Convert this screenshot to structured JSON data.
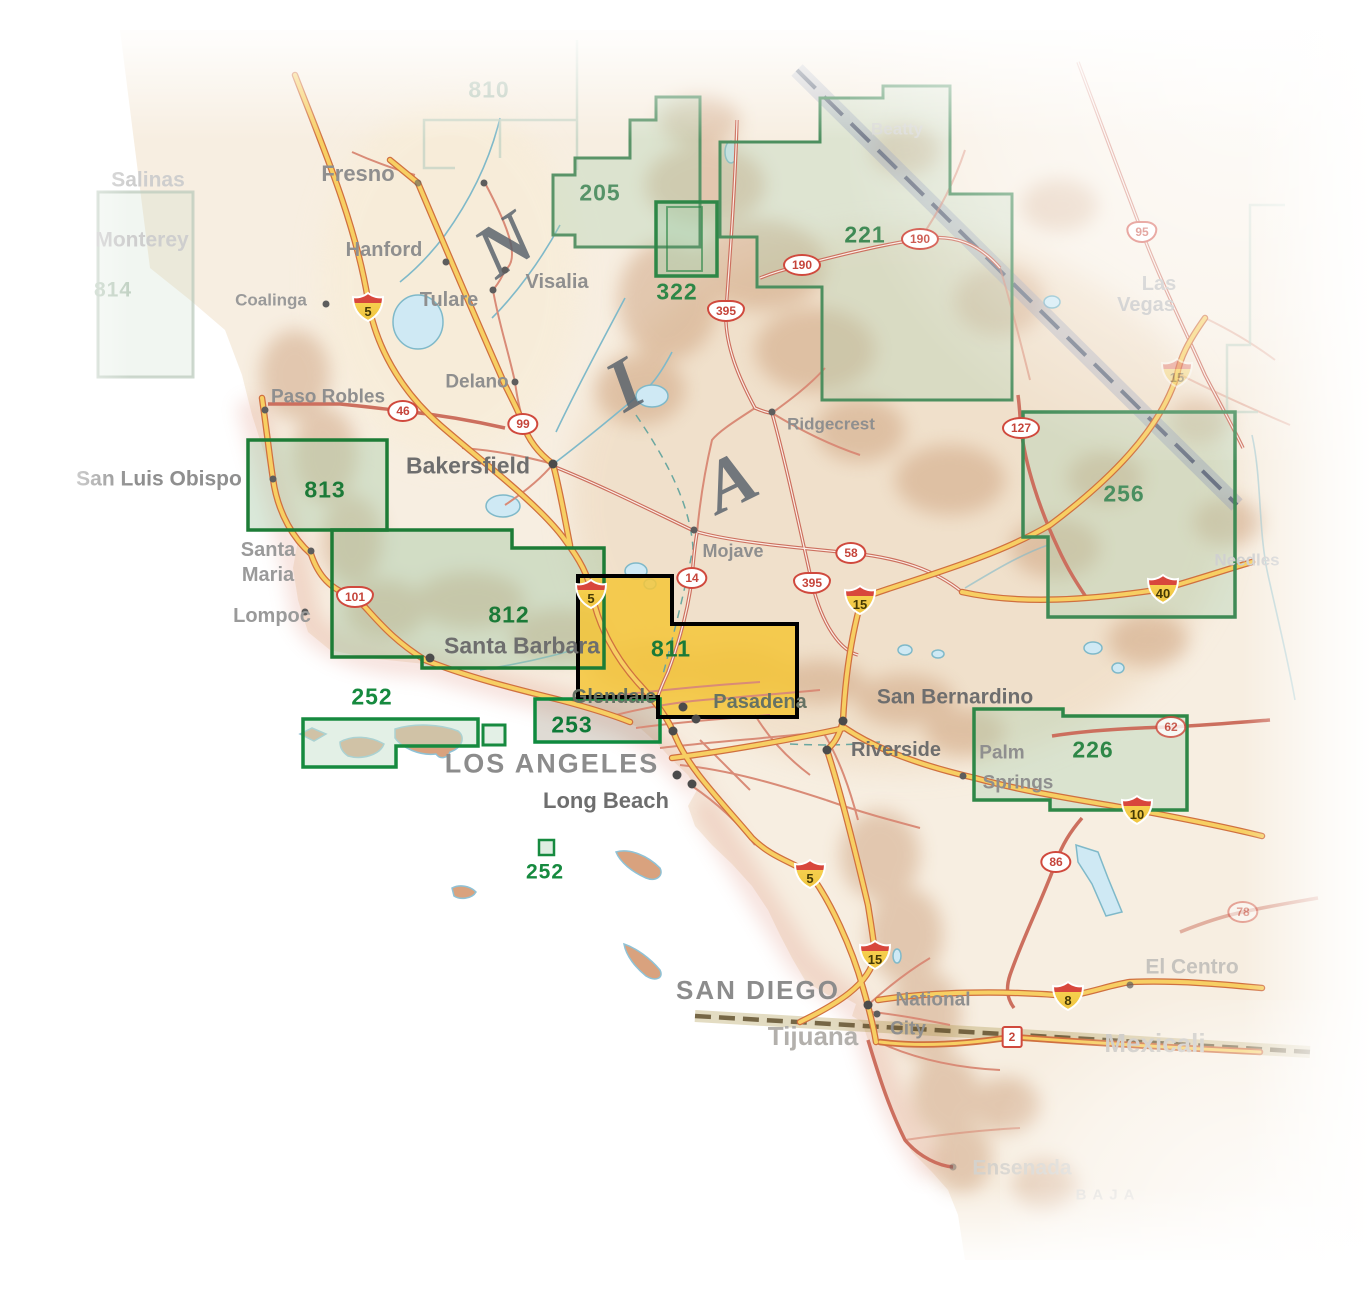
{
  "map_areas": {
    "a810": "810",
    "a814": "814",
    "a205": "205",
    "a322": "322",
    "a221": "221",
    "a813": "813",
    "a812": "812",
    "a811": "811",
    "a253": "253",
    "a252": "252",
    "a252b": "252",
    "a256": "256",
    "a226": "226"
  },
  "highlight": {
    "number": "811",
    "fill": "#F2C33C",
    "border": "#000000"
  },
  "colors": {
    "area_border": "#1E8040",
    "area_fill": "#BFD8C2",
    "number_green": "#1C7A38"
  },
  "letters": {
    "n": "N",
    "i": "I",
    "a": "A"
  },
  "cities": {
    "fresno": "Fresno",
    "hanford": "Hanford",
    "visalia": "Visalia",
    "tulare": "Tulare",
    "delano": "Delano",
    "coalinga": "Coalinga",
    "paso_robles": "Paso Robles",
    "san_luis_obispo": "San Luis Obispo",
    "santa_maria_1": "Santa",
    "santa_maria_2": "Maria",
    "lompoc": "Lompoc",
    "bakersfield": "Bakersfield",
    "ridgecrest": "Ridgecrest",
    "mojave": "Mojave",
    "santa_barbara": "Santa Barbara",
    "glendale": "Glendale",
    "pasadena": "Pasadena",
    "san_bernardino": "San Bernardino",
    "riverside": "Riverside",
    "palm_springs_1": "Palm",
    "palm_springs_2": "Springs",
    "los_angeles": "LOS ANGELES",
    "long_beach": "Long Beach",
    "san_diego": "SAN DIEGO",
    "national_city_1": "National",
    "national_city_2": "City",
    "tijuana": "Tijuana",
    "el_centro": "El Centro",
    "mexicali": "Mexicali",
    "ensenada": "Ensenada",
    "needles": "Needles",
    "beatty": "Beatty",
    "las_vegas_1": "Las",
    "las_vegas_2": "Vegas",
    "salinas": "Salinas",
    "monterey": "Monterey",
    "baja": "BAJA"
  },
  "shields": {
    "i5": "5",
    "i15": "15",
    "i40": "40",
    "i10": "10",
    "i8": "8",
    "us101": "101",
    "us395": "395",
    "us95": "95",
    "ca99": "99",
    "ca46": "46",
    "us190": "190",
    "ca58": "58",
    "ca14": "14",
    "ca127": "127",
    "ca62": "62",
    "ca86": "86",
    "ca78": "78",
    "mx2": "2"
  }
}
